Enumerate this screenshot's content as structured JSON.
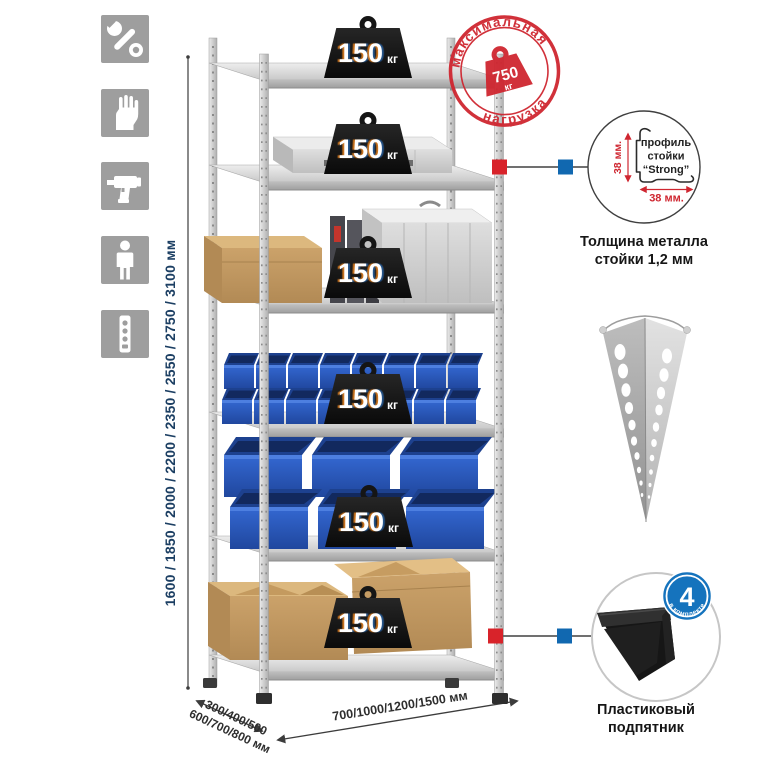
{
  "canvas": {
    "width": 765,
    "height": 765,
    "background": "#ffffff"
  },
  "sidebar": {
    "icons": [
      {
        "name": "wrench-icon"
      },
      {
        "name": "gloves-icon"
      },
      {
        "name": "drill-icon"
      },
      {
        "name": "person-icon"
      },
      {
        "name": "power-strip-icon"
      }
    ]
  },
  "dimensions": {
    "height_label": "1600 / 1850 / 2000 / 2200 / 2350 / 2550 / 2750 / 3100 мм",
    "depth_line1": "300/400/500",
    "depth_line2": "600/700/800 мм",
    "width_label": "700/1000/1200/1500 мм"
  },
  "shelf_loads": [
    {
      "value": "150",
      "unit": "кг"
    },
    {
      "value": "150",
      "unit": "кг"
    },
    {
      "value": "150",
      "unit": "кг"
    },
    {
      "value": "150",
      "unit": "кг"
    },
    {
      "value": "150",
      "unit": "кг"
    },
    {
      "value": "150",
      "unit": "кг"
    }
  ],
  "max_load_stamp": {
    "arc_top": "максимальная",
    "arc_bottom": "нагрузка",
    "value": "750",
    "unit": "кг",
    "color": "#cf2630"
  },
  "profile_detail": {
    "label_line1": "профиль",
    "label_line2": "стойки",
    "label_line3": "“Strong”",
    "dim_vertical": "38 мм.",
    "dim_horizontal": "38 мм.",
    "caption_line1": "Толщина металла",
    "caption_line2": "стойки 1,2 мм"
  },
  "foot_detail": {
    "badge_value": "4",
    "badge_arc_text": "в комплекте",
    "caption_line1": "Пластиковый",
    "caption_line2": "подпятник"
  },
  "colors": {
    "accent_red": "#d8232a",
    "accent_blue": "#1168b0",
    "stamp_red": "#cf2630",
    "dim_text_blue": "#1c3f63",
    "icon_gray": "#9e9e9e",
    "bin_blue": "#2f62cc",
    "metal_gray": "#cfcfcf",
    "cardboard": "#c79f66"
  }
}
